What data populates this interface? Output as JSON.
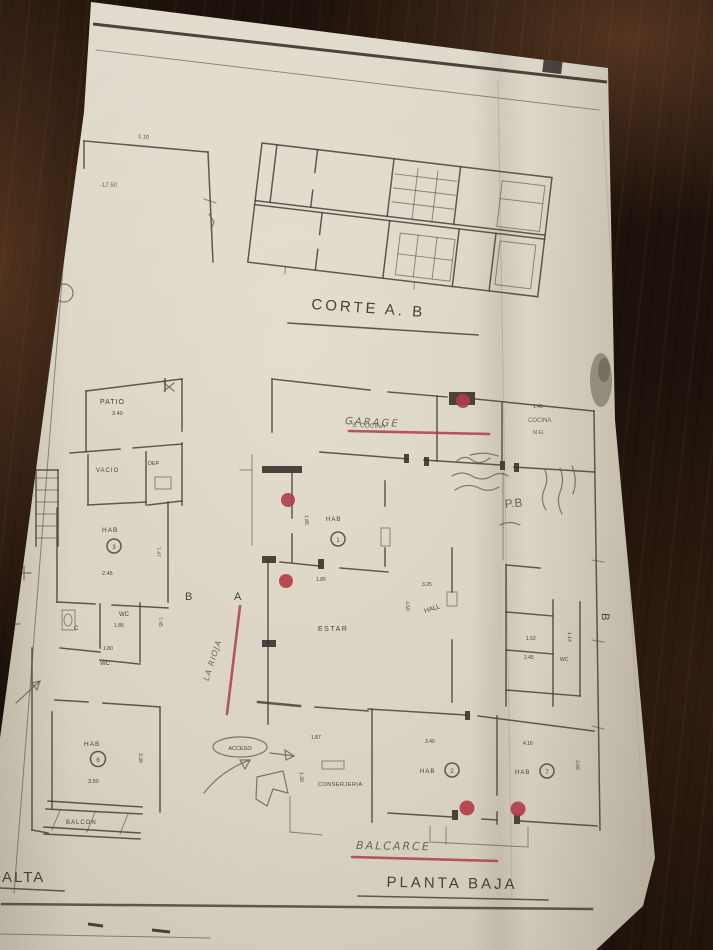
{
  "scene": {
    "description": "Photograph of a hand-drawn architectural plan sheet lying on a dark wooden table"
  },
  "colors": {
    "wood_dark": "#1d120b",
    "paper": "#e3ddcd",
    "ink": "#46413a",
    "pencil": "#6b6459",
    "red": "#b23b48"
  },
  "titles": {
    "corte": "CORTE A. B",
    "planta_baja": "PLANTA BAJA",
    "planta_alta": "ALTA"
  },
  "annotations": {
    "garage": "GARAGE",
    "s_cocina": "S. COCINA",
    "balcarce": "BALCARCE",
    "la_rioja": "LA RIOJA",
    "pb": "P.B",
    "level": "-17.50"
  },
  "rooms": {
    "patio": "PATIO",
    "vacio": "VACIO",
    "dep": "DEP",
    "hab": "HAB",
    "estar": "ESTAR",
    "hall": "HALL",
    "acceso": "ACCESO",
    "conserjeria": "CONSERJERIA",
    "balcon": "BALCON",
    "wc": "WC",
    "closet": "C",
    "cocina": "COCINA",
    "cocina_sub": "M.EL"
  },
  "markers": {
    "a": "A",
    "b": "B"
  },
  "numbers": {
    "n1": "1",
    "n2": "2",
    "n3": "3",
    "n6": "6",
    "n7": "7"
  },
  "dims": {
    "d110": "1.10",
    "d130": "1.30",
    "d145": "1.45",
    "d152": "1.52",
    "d114": "1.14",
    "d180": "1.80",
    "d185": "1.85",
    "d187": "1.87",
    "d245": "2.45",
    "d306": "3.06",
    "d325": "3.25",
    "d330": "3.30",
    "d340": "3.40",
    "d350": "3.50",
    "d416": "4.16",
    "d450": "4.50",
    "d745": "7.45",
    "d747": "7.47"
  }
}
